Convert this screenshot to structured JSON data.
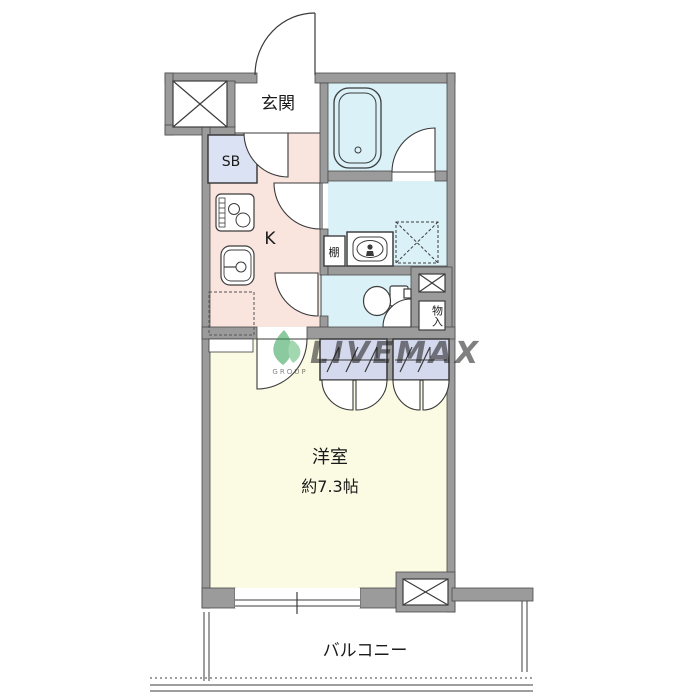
{
  "plan": {
    "type": "floorplan",
    "rooms": {
      "genkan": {
        "label": "玄関"
      },
      "shoe_box": {
        "label": "SB"
      },
      "kitchen": {
        "label": "K"
      },
      "shelf": {
        "label": "棚"
      },
      "storage": {
        "label": "物入"
      },
      "living": {
        "label": "洋室",
        "size": "約7.3帖"
      },
      "balcony": {
        "label": "バルコニー"
      }
    },
    "fixtures": [
      "bathtub",
      "washbasin",
      "washer-pan",
      "toilet",
      "stove",
      "sink",
      "refrigerator-space",
      "pipe-space-top-left",
      "pipe-space-mid-right",
      "pipe-space-bottom-right",
      "closet",
      "closet",
      "window",
      "entrance-door"
    ],
    "colors": {
      "wall": "#9b9b9b",
      "line": "#3c3c3c",
      "kitchen_hall": "#f9e4de",
      "wet_area": "#d9f1f7",
      "living": "#fbfae3",
      "shoe_box": "#dbe2f3",
      "closet": "#d5d9ee",
      "watermark_green": "#2e9e4f",
      "watermark_blue": "#9fb0d8"
    }
  },
  "watermark": {
    "text": "LIVEMAX",
    "sub": "GROUP"
  }
}
